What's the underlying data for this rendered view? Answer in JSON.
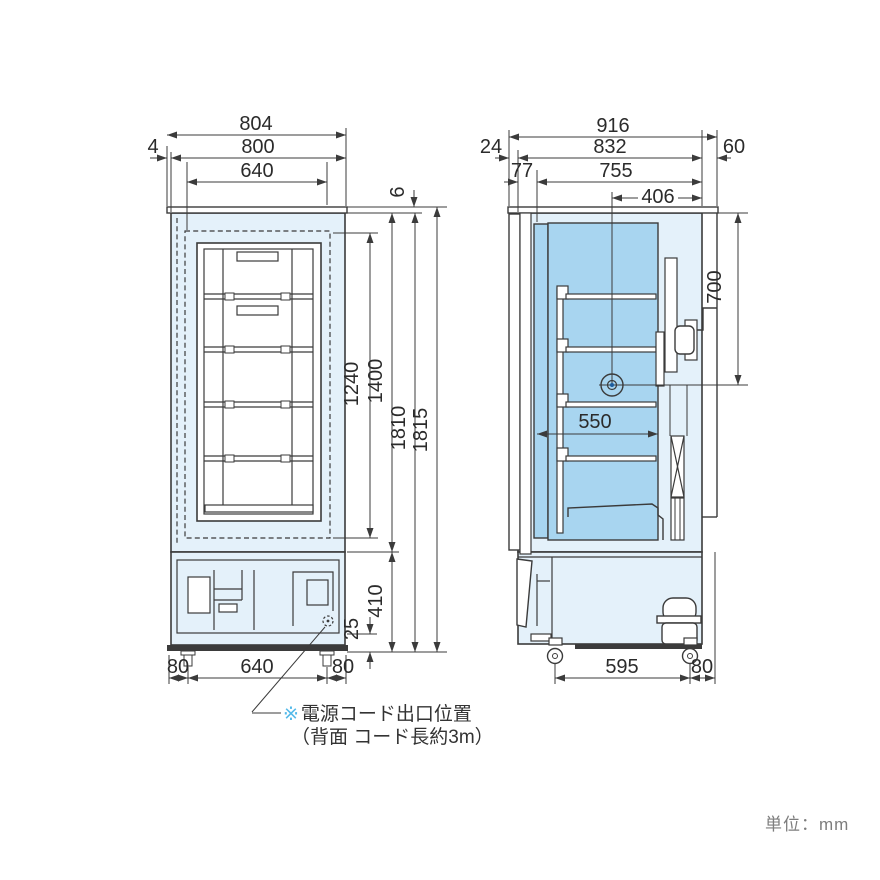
{
  "drawing": {
    "front_view": {
      "width_outer": "804",
      "width_body": "800",
      "width_door_inner": "640",
      "offset_plate_left": "4",
      "top_lip": "6",
      "height_inner": "1240",
      "height_door": "1400",
      "height_body": "1810",
      "height_total": "1815",
      "height_machine": "410",
      "base_clearance": "25",
      "foot_offset_left": "80",
      "foot_span": "640",
      "foot_offset_right": "80"
    },
    "side_view": {
      "depth_total": "916",
      "depth_body": "832",
      "offset_front": "24",
      "offset_rear": "60",
      "door_thickness": "77",
      "depth_inner": "755",
      "port_from_rear": "406",
      "port_from_top": "700",
      "shelf_depth": "550",
      "caster_span": "595",
      "caster_offset_rear": "80"
    },
    "note": {
      "marker": "※",
      "line1": "電源コード出口位置",
      "line2": "（背面 コード長約3m）"
    },
    "unit_label": "単位：mm"
  }
}
